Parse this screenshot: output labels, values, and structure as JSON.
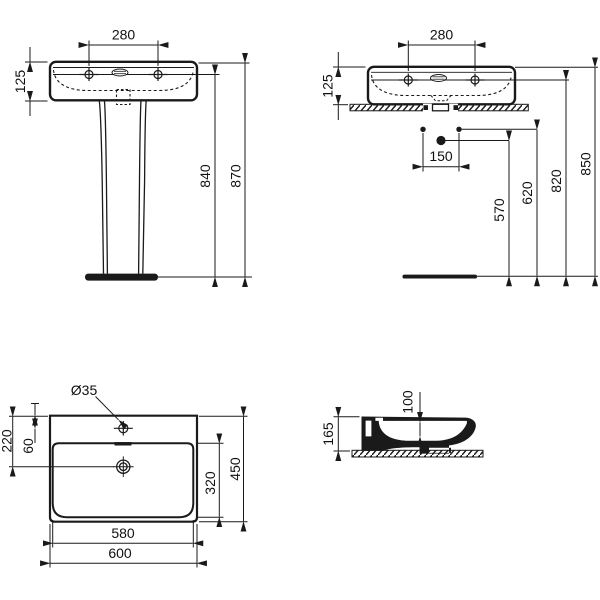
{
  "drawing": {
    "front_view": {
      "tap_spacing": "280",
      "basin_height": "125",
      "rim_to_floor": "840",
      "total_height": "870"
    },
    "wall_view": {
      "tap_spacing": "280",
      "basin_height": "125",
      "fixing_centers": "150",
      "outlet_height": "570",
      "fixing_height": "620",
      "rim_to_floor": "820",
      "total_height": "850"
    },
    "plan_view": {
      "tap_hole_diameter": "Ø35",
      "outlet_from_rear": "220",
      "tap_from_rear": "60",
      "bowl_depth": "320",
      "overall_depth": "450",
      "bowl_width": "580",
      "overall_width": "600"
    },
    "section_view": {
      "basin_height": "165",
      "bowl_depth": "100"
    }
  }
}
